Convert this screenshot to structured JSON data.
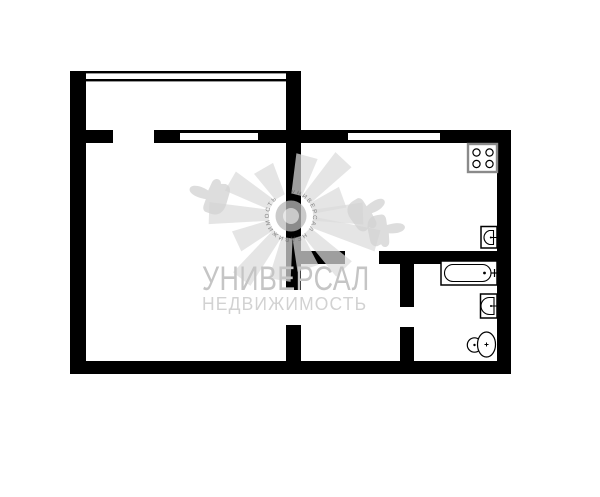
{
  "page": {
    "background": "#ffffff"
  },
  "plan": {
    "wall_color": "#000000",
    "fixture_stroke_color": "#000000",
    "stove_border_color": "#8a8a8a",
    "rooms_visible_count": 5,
    "fixtures": [
      "stove-icon",
      "kitchen-sink-icon",
      "bathtub-icon",
      "bathroom-sink-icon",
      "toilet-icon"
    ],
    "windows": [
      "balcony-glazing",
      "room-window",
      "kitchen-window"
    ]
  },
  "watermark": {
    "title": "УНИВЕРСАЛ",
    "subtitle": "НЕДВИЖИМОСТЬ",
    "emblem_text": "УНИВЕРСАЛ  НЕДВИЖИМОСТЬ",
    "shape_color": "rgba(219,219,219,0.72)",
    "hand_color": "rgba(210,210,210,0.75)",
    "title_color": "#c5c5c5",
    "subtitle_color": "#d2d2d2"
  }
}
